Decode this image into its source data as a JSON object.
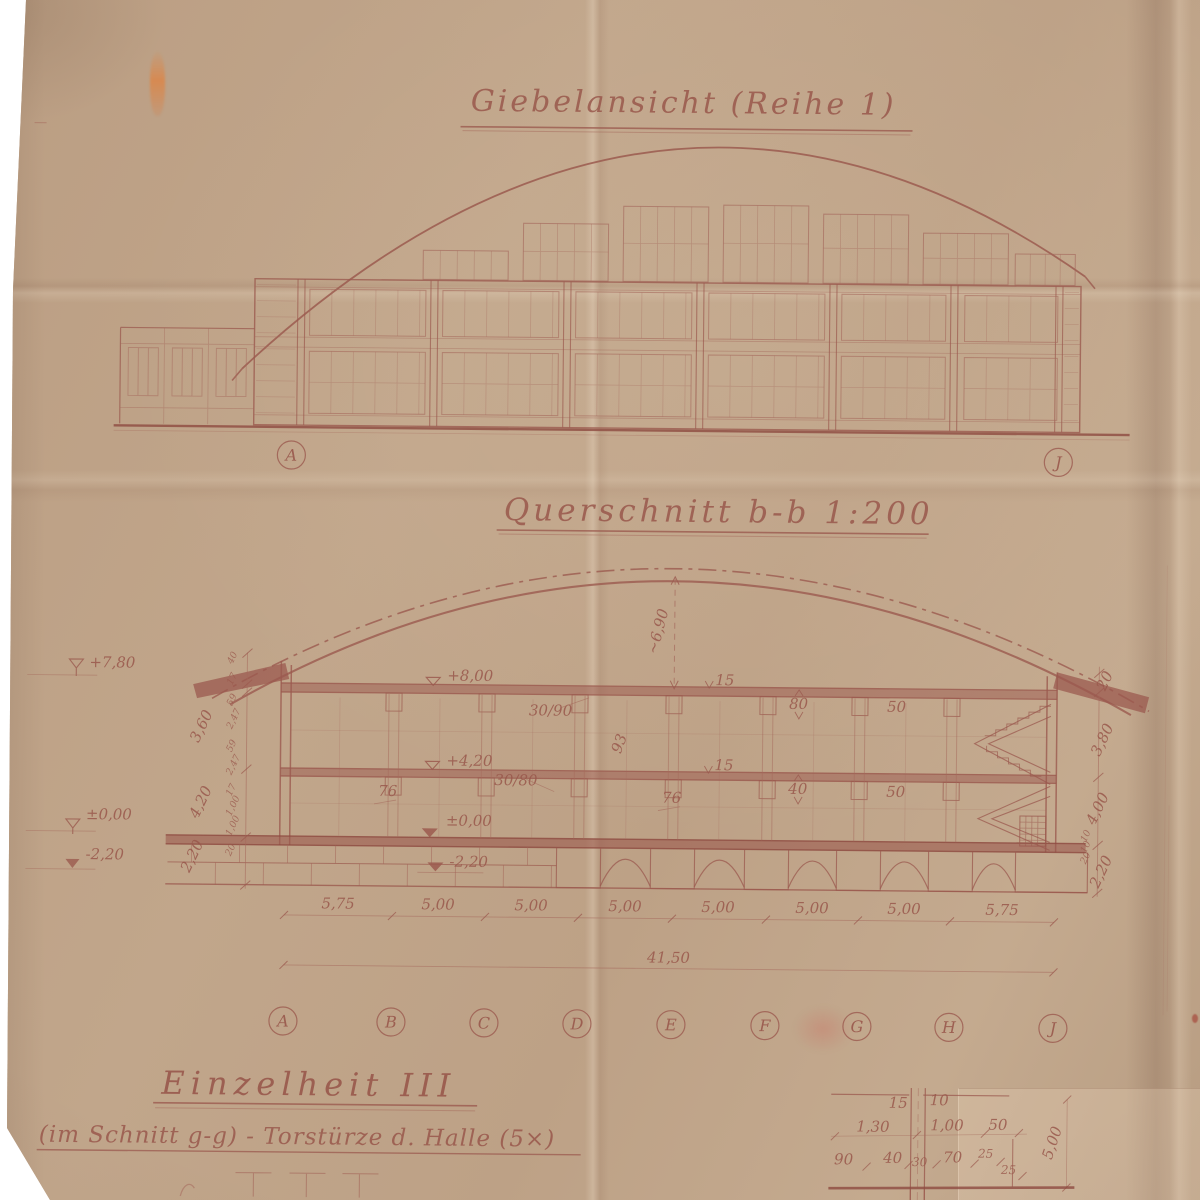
{
  "titles": {
    "gable": "Giebelansicht (Reihe 1)",
    "section": "Querschnitt b-b 1:200",
    "detail": "Einzelheit III",
    "detail_subtitle": "(im Schnitt g-g) - Torstürze d. Halle (5×)"
  },
  "grid_letters": [
    "A",
    "B",
    "C",
    "D",
    "E",
    "F",
    "G",
    "H",
    "J"
  ],
  "section": {
    "levels": {
      "parapet_left": "+7,80",
      "zero_left": "±0,00",
      "foundation_left": "-2,20",
      "roof": "+8,00",
      "floor": "+4,20",
      "zero": "±0,00",
      "foundation": "-2,20"
    },
    "arch_rise": "~6,90",
    "members": {
      "roof_beam": "30/90",
      "floor_beam": "30/80",
      "roof_slab": "15",
      "floor_slab": "15",
      "roof_beam_depth": "80",
      "floor_beam_depth": "40",
      "roof_beam_width": "50",
      "floor_beam_width": "50",
      "column_a": "76",
      "column_b": "76",
      "wall": "93"
    },
    "left_chain": [
      "3,60",
      "4,20",
      "2,20"
    ],
    "left_chain_small": [
      "40",
      "17",
      "59",
      "2,47",
      "59",
      "2,47",
      "17",
      "1,00",
      "1,00",
      "20"
    ],
    "right_chain": [
      "20",
      "3,80",
      "4,00",
      "2,20"
    ],
    "right_chain_small": [
      "10",
      "10",
      "20"
    ],
    "bottom_dims": [
      "5,75",
      "5,00",
      "5,00",
      "5,00",
      "5,00",
      "5,00",
      "5,00",
      "5,75"
    ],
    "total_dim": "41,50"
  },
  "detail": {
    "row1": [
      "15",
      "10"
    ],
    "row2": [
      "1,30",
      "1,00",
      "50"
    ],
    "row3": [
      "90",
      "40",
      "30",
      "70",
      "25",
      "25"
    ],
    "height_dim": "5,00"
  },
  "colors": {
    "ink": "#9b5a4f",
    "paper": "#bca186"
  }
}
